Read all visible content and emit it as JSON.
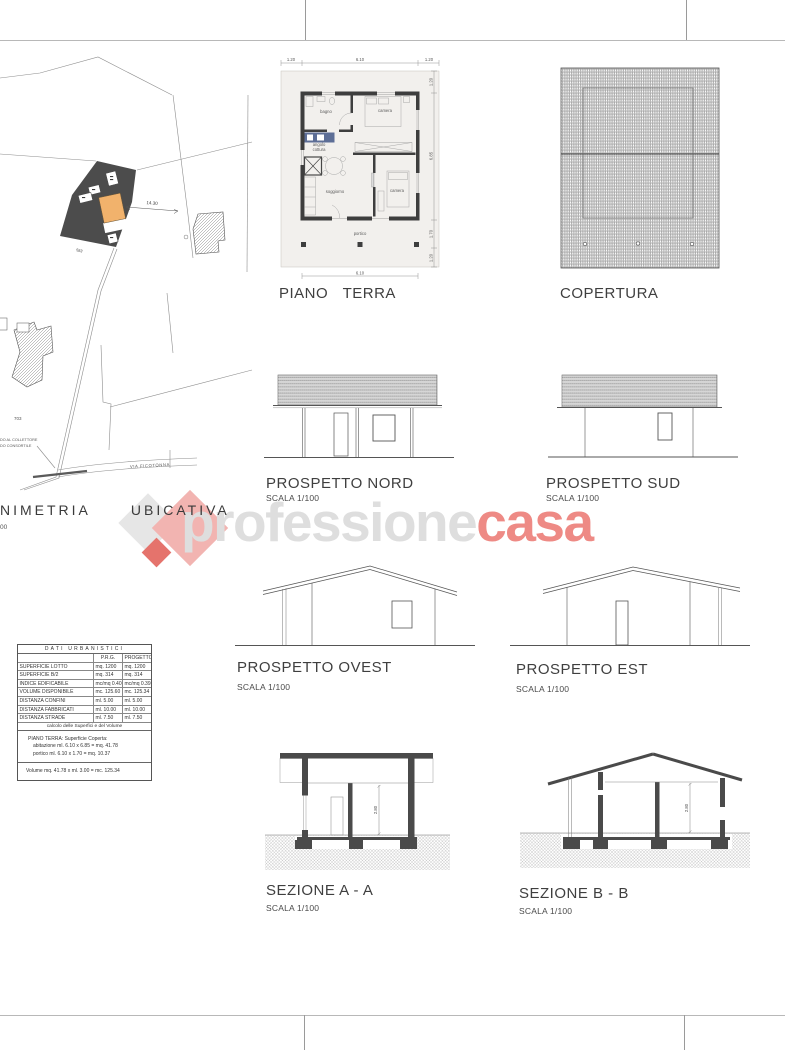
{
  "site_plan": {
    "title_word1": "NIMETRIA",
    "title_word2": "UBICATIVA",
    "scale_fragment": "00",
    "parcel_number": "703",
    "street_label": "VIA FICOTONNA",
    "note_line1": "DO AL COLLETTORE",
    "note_line2": "DO CONSORTILE",
    "dim_label": "14.30",
    "edge_label": "583"
  },
  "floor_plan": {
    "title": "PIANO TERRA",
    "rooms": {
      "bathroom": "bagno",
      "bedroom1": "camera",
      "kitchenette_line1": "angolo",
      "kitchenette_line2": "cottura",
      "living": "soggiorno",
      "bedroom2": "camera",
      "porch": "portico"
    },
    "dims": {
      "top_left": "1.20",
      "top_center": "6.10",
      "top_right": "1.20",
      "bottom": "6.10",
      "right_eave_top": "1.20",
      "right_house": "6.85",
      "right_porch": "1.70",
      "right_eave_bottom": "1.20"
    }
  },
  "roof_plan": {
    "title": "COPERTURA"
  },
  "elevations": {
    "north": {
      "title": "PROSPETTO NORD",
      "scale": "SCALA 1/100"
    },
    "south": {
      "title": "PROSPETTO SUD",
      "scale": "SCALA 1/100"
    },
    "west": {
      "title": "PROSPETTO OVEST",
      "scale": "SCALA 1/100"
    },
    "east": {
      "title": "PROSPETTO EST",
      "scale": "SCALA 1/100"
    }
  },
  "sections": {
    "aa": {
      "title": "SEZIONE A - A",
      "scale": "SCALA 1/100",
      "height_dim": "2.80"
    },
    "bb": {
      "title": "SEZIONE B - B",
      "scale": "SCALA 1/100",
      "height_dim": "2.80"
    }
  },
  "urban_data_table": {
    "title": "DATI URBANISTICI",
    "col_prg": "P.R.G.",
    "col_prog": "PROGETTO",
    "rows": [
      {
        "label": "SUPERFICIE LOTTO",
        "prg": "mq. 1200",
        "prog": "mq. 1200"
      },
      {
        "label": "SUPERFICIE B/2",
        "prg": "mq. 314",
        "prog": "mq. 314"
      },
      {
        "label": "INDICE EDIFICABILE",
        "prg": "mc/mq 0.40",
        "prog": "mc/mq 0.39"
      },
      {
        "label": "VOLUME DISPONIBILE",
        "prg": "mc. 125.60",
        "prog": "mc. 125.34"
      },
      {
        "label": "DISTANZA CONFINI",
        "prg": "ml. 5.00",
        "prog": "ml. 5.00"
      },
      {
        "label": "DISTANZA FABBRICATI",
        "prg": "ml. 10.00",
        "prog": "ml. 10.00"
      },
      {
        "label": "DISTANZA STRADE",
        "prg": "ml. 7.50",
        "prog": "ml. 7.50"
      }
    ],
    "calc_header": "calcolo delle Superfici e del Volume",
    "calc_line1": "PIANO TERRA: Superficie Coperta:",
    "calc_line2": "abitazione ml. 6.10 x 6.85 = mq. 41.78",
    "calc_line3": "portico ml. 6.10 x 1.70 = mq. 10.37",
    "volume_line": "Volume mq. 41.78 x ml. 3.00 = mc. 125.34"
  },
  "watermark": {
    "brand_gray": "professione",
    "brand_red": "casa"
  }
}
